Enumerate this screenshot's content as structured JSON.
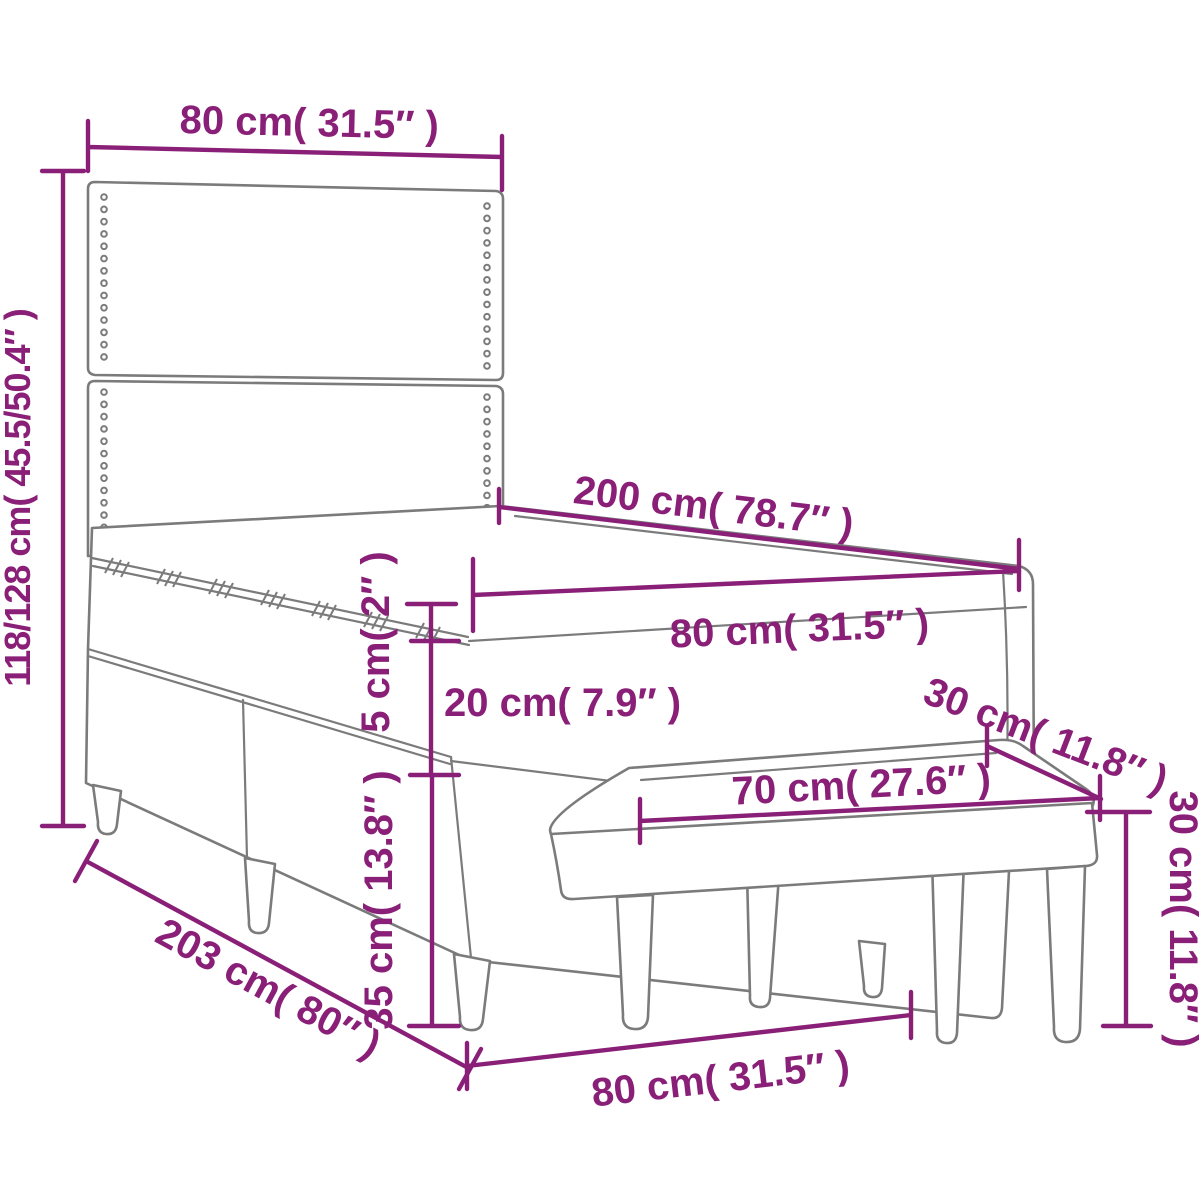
{
  "diagram": {
    "type": "furniture-dimension-drawing",
    "subject": "box-spring bed with headboard, mattress topper and footstool bench"
  },
  "dimensions": {
    "headboard_width_top": "80 cm( 31.5″ )",
    "headboard_height": "118/128 cm( 45.5/50.4″ )",
    "bed_length": "200 cm( 78.7″ )",
    "mattress_width": "80 cm( 31.5″ )",
    "topper_thickness": "5 cm( 2″ )",
    "mattress_thickness": "20 cm( 7.9″ )",
    "base_height": "35 cm( 13.8″ )",
    "total_length": "203 cm( 80″ )",
    "bed_width_bottom": "80 cm( 31.5″ )",
    "bench_length": "70 cm( 27.6″ )",
    "bench_depth": "30 cm( 11.8″ )",
    "bench_height": "30 cm( 11.8″ )"
  },
  "colors": {
    "dimension_accent": "#8A1F78",
    "outline_gray": "#7B7B7B",
    "background": "#FFFFFF"
  }
}
